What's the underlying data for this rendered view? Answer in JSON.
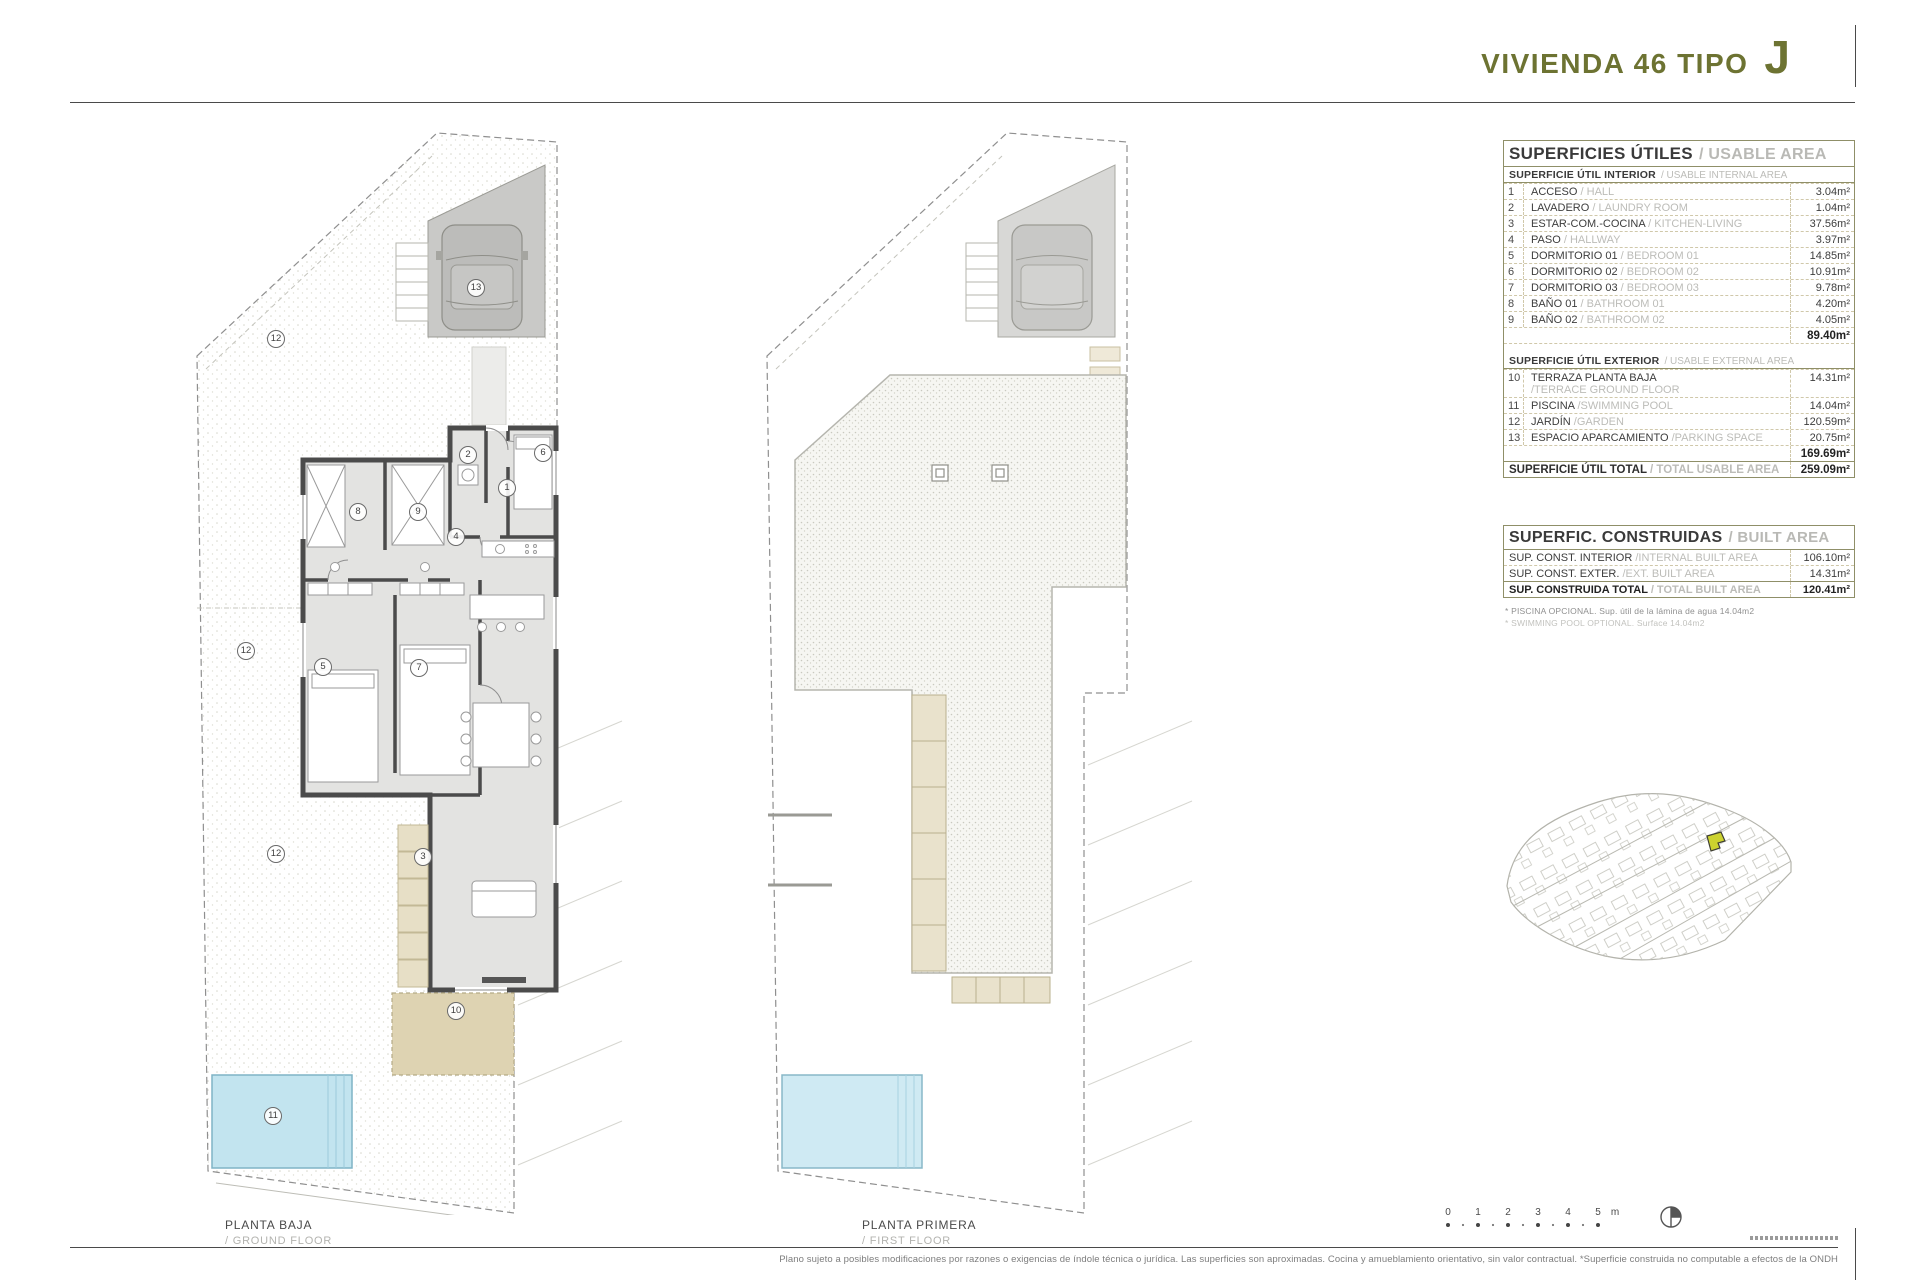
{
  "header": {
    "title": "VIVIENDA 46 TIPO",
    "letter": "J",
    "accent_color": "#6d7332"
  },
  "plans": {
    "ground": {
      "label_es": "PLANTA BAJA",
      "label_en": "/ GROUND FLOOR",
      "numbers": {
        "hall": "1",
        "laundry": "2",
        "living": "3",
        "hallway": "4",
        "bedroom1": "5",
        "bedroom2": "6",
        "bedroom3": "7",
        "bath1": "8",
        "bath2": "9",
        "terrace": "10",
        "pool": "11",
        "garden": "12",
        "parking": "13"
      }
    },
    "first": {
      "label_es": "PLANTA PRIMERA",
      "label_en": "/ FIRST FLOOR"
    }
  },
  "usable": {
    "title_es": "SUPERFICIES ÚTILES",
    "title_en": "/ USABLE AREA",
    "interior": {
      "header_es": "SUPERFICIE ÚTIL INTERIOR",
      "header_en": "/ USABLE INTERNAL AREA",
      "rows": [
        {
          "num": "1",
          "es": "ACCESO",
          "en": "/ HALL",
          "area": "3.04m²"
        },
        {
          "num": "2",
          "es": "LAVADERO",
          "en": "/ LAUNDRY ROOM",
          "area": "1.04m²"
        },
        {
          "num": "3",
          "es": "ESTAR-COM.-COCINA",
          "en": "/ KITCHEN-LIVING",
          "area": "37.56m²"
        },
        {
          "num": "4",
          "es": "PASO",
          "en": "/ HALLWAY",
          "area": "3.97m²"
        },
        {
          "num": "5",
          "es": "DORMITORIO 01",
          "en": "/ BEDROOM 01",
          "area": "14.85m²"
        },
        {
          "num": "6",
          "es": "DORMITORIO 02",
          "en": "/ BEDROOM 02",
          "area": "10.91m²"
        },
        {
          "num": "7",
          "es": "DORMITORIO 03",
          "en": "/ BEDROOM 03",
          "area": "9.78m²"
        },
        {
          "num": "8",
          "es": "BAÑO 01",
          "en": "/ BATHROOM 01",
          "area": "4.20m²"
        },
        {
          "num": "9",
          "es": "BAÑO 02",
          "en": "/ BATHROOM 02",
          "area": "4.05m²"
        }
      ],
      "subtotal": "89.40m²"
    },
    "exterior": {
      "header_es": "SUPERFICIE ÚTIL EXTERIOR",
      "header_en": "/ USABLE EXTERNAL AREA",
      "rows": [
        {
          "num": "10",
          "es": "TERRAZA PLANTA BAJA",
          "en": "/TERRACE GROUND FLOOR",
          "area": "14.31m²"
        },
        {
          "num": "11",
          "es": "PISCINA",
          "en": "/SWIMMING POOL",
          "area": "14.04m²"
        },
        {
          "num": "12",
          "es": "JARDÍN",
          "en": "/GARDEN",
          "area": "120.59m²"
        },
        {
          "num": "13",
          "es": "ESPACIO APARCAMIENTO",
          "en": "/PARKING SPACE",
          "area": "20.75m²"
        }
      ],
      "subtotal": "169.69m²"
    },
    "total_es": "SUPERFICIE ÚTIL TOTAL",
    "total_en": "/ TOTAL USABLE AREA",
    "total_area": "259.09m²"
  },
  "built": {
    "title_es": "SUPERFIC. CONSTRUIDAS",
    "title_en": "/ BUILT AREA",
    "rows": [
      {
        "es": "SUP. CONST. INTERIOR",
        "en": "/INTERNAL BUILT AREA",
        "area": "106.10m²"
      },
      {
        "es": "SUP. CONST. EXTER.",
        "en": "/EXT. BUILT AREA",
        "area": "14.31m²"
      },
      {
        "es": "SUP. CONSTRUIDA TOTAL",
        "en": "/ TOTAL BUILT AREA",
        "area": "120.41m²"
      }
    ]
  },
  "footnotes": {
    "line1": "* PISCINA OPCIONAL. Sup. útil de la lámina de agua 14.04m2",
    "line2": "* SWIMMING POOL OPTIONAL. Surface 14.04m2"
  },
  "scale_bar": {
    "ticks": [
      "0",
      "1",
      "2",
      "3",
      "4",
      "5"
    ],
    "unit": "m"
  },
  "disclaimer": "Plano sujeto a posibles modificaciones por razones o exigencias de índole técnica o jurídica. Las superficies son aproximadas. Cocina y amueblamiento orientativo, sin valor contractual. *Superficie construida no computable a efectos de la ONDH"
}
